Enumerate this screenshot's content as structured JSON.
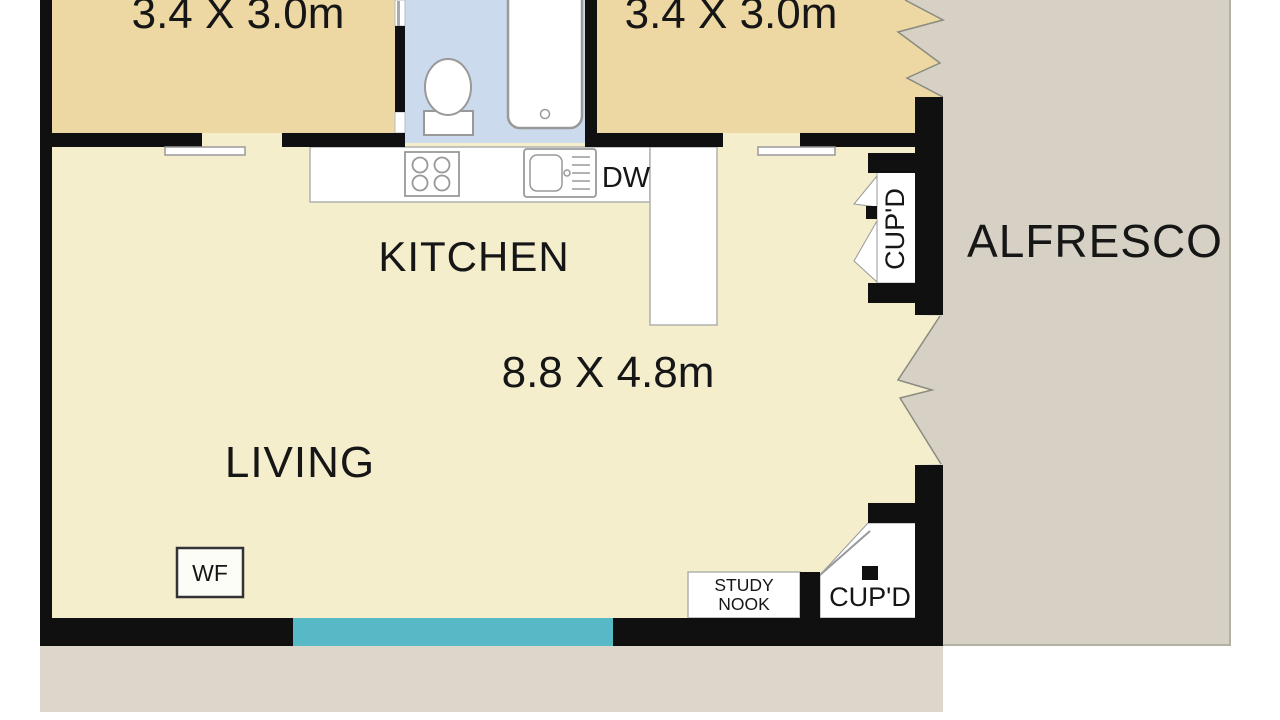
{
  "floorplan": {
    "title": "Residential floor plan",
    "labels": {
      "bedroom1_dims": "3.4 X 3.0m",
      "bedroom2_dims": "3.4 X 3.0m",
      "kitchen": "KITCHEN",
      "living": "LIVING",
      "living_dims": "8.8 X 4.8m",
      "alfresco": "ALFRESCO",
      "dishwasher": "DW",
      "cupboard_upper": "CUP'D",
      "cupboard_lower": "CUP'D",
      "study_nook_line1": "STUDY",
      "study_nook_line2": "NOOK",
      "wood_fire": "WF"
    },
    "colors": {
      "page_bg": "#ffffff",
      "wall": "#101010",
      "bedroom_fill": "#edd8a3",
      "living_fill": "#f4eecd",
      "bathroom_fill": "#ccdaee",
      "alfresco_fill": "#d6d1c4",
      "ground_fill": "#dcd7ca",
      "window_teal": "#57b9c6",
      "fixture_outline": "#999999",
      "text": "#161616"
    }
  }
}
